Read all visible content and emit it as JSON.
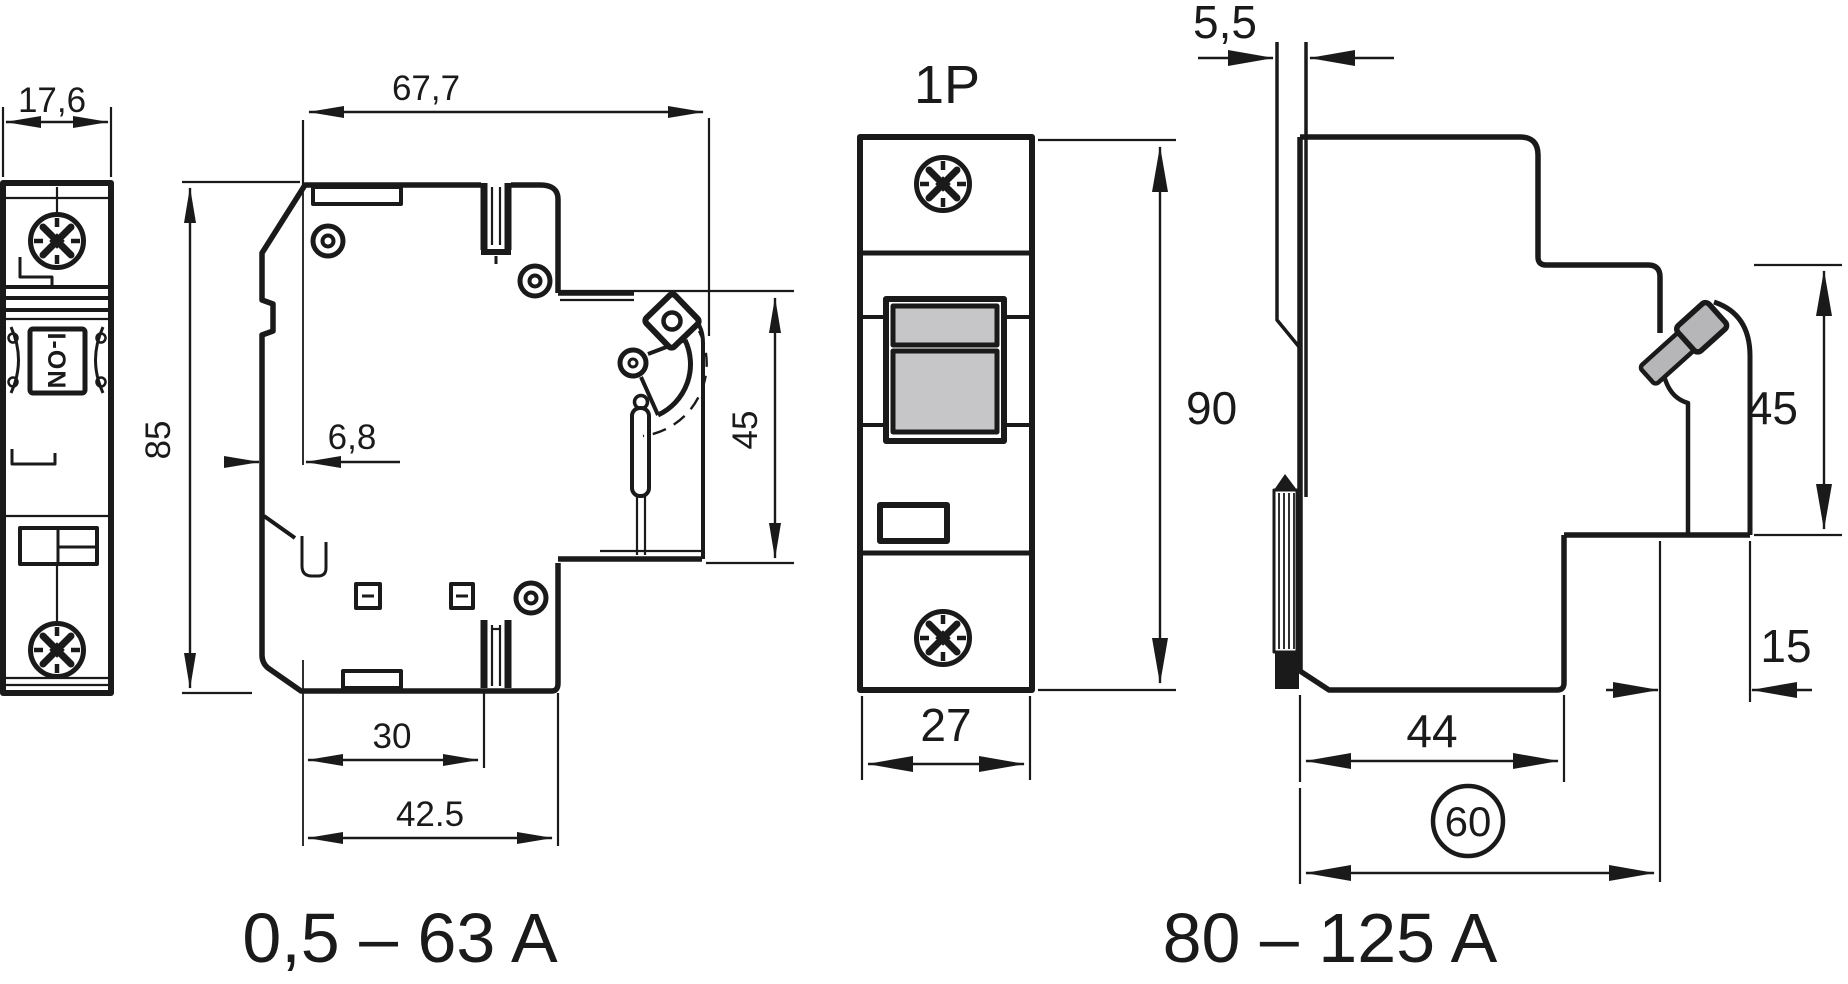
{
  "drawing": {
    "labels": {
      "pole_label": "1P",
      "toggle_marking": "I-ON"
    },
    "captions": {
      "small_breaker_range": "0,5 – 63 A",
      "large_breaker_range": "80 – 125 A"
    },
    "dimensions": {
      "front_width_small": "17,6",
      "total_depth_small": "67,7",
      "height_small": "85",
      "rail_offset_small": "6,8",
      "din_zone_small": "45",
      "foot_offset_small": "30",
      "base_depth_small": "42.5",
      "height_large": "90",
      "front_width_large": "27",
      "busbar_thickness": "5,5",
      "din_zone_large": "45",
      "recess_width_large": "15",
      "base_depth_large": "44",
      "total_depth_large": "60"
    },
    "colors": {
      "line": "#1a1a1a",
      "toggle_gray": "#c6c6c8",
      "lever_gray": "#b6b6b8",
      "background": "#ffffff"
    }
  }
}
